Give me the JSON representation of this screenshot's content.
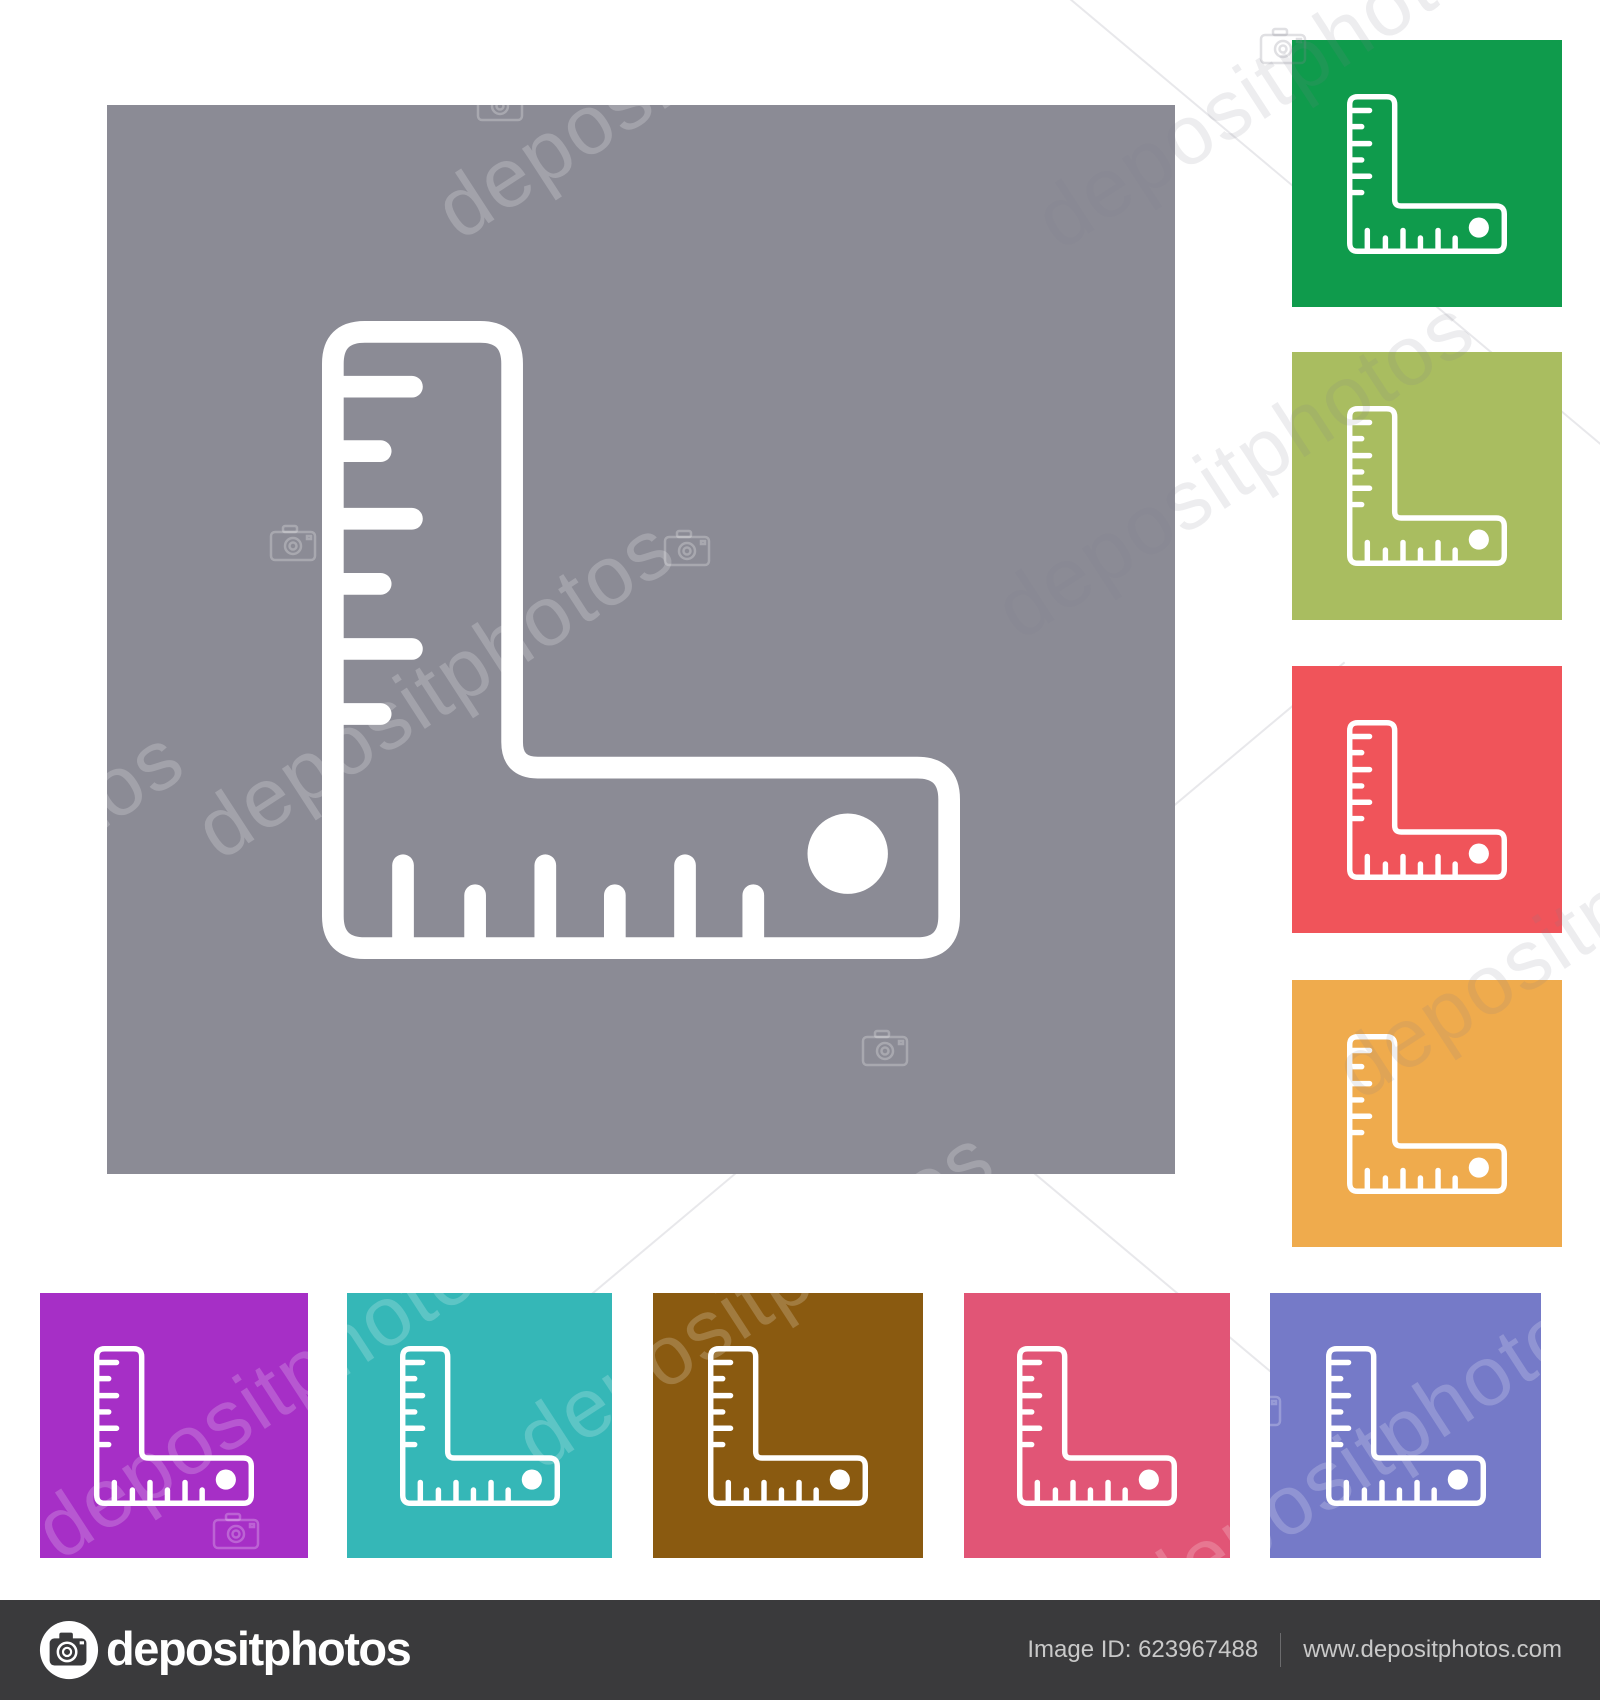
{
  "watermark": {
    "text": "depositphotos"
  },
  "icon": {
    "name": "l-shaped-ruler",
    "stroke_color": "#ffffff"
  },
  "tiles": [
    {
      "id": "main",
      "label": "gray",
      "color": "#8b8b95"
    },
    {
      "id": "green",
      "label": "green",
      "color": "#0f9b4c"
    },
    {
      "id": "olive",
      "label": "yellow-green",
      "color": "#a9bd60"
    },
    {
      "id": "red",
      "label": "red",
      "color": "#f0545a"
    },
    {
      "id": "orange",
      "label": "orange",
      "color": "#efab4d"
    },
    {
      "id": "purple",
      "label": "purple",
      "color": "#a62fc6"
    },
    {
      "id": "teal",
      "label": "teal",
      "color": "#35b7b7"
    },
    {
      "id": "brown",
      "label": "brown",
      "color": "#8a5a10"
    },
    {
      "id": "pink",
      "label": "pink",
      "color": "#e15576"
    },
    {
      "id": "slate",
      "label": "slate-blue",
      "color": "#757ac8"
    }
  ],
  "footer": {
    "brand": "depositphotos",
    "image_id_label": "Image ID: 623967488",
    "website": "www.depositphotos.com",
    "bar_color": "#3a3a3c",
    "text_color": "#c9c9c9"
  }
}
